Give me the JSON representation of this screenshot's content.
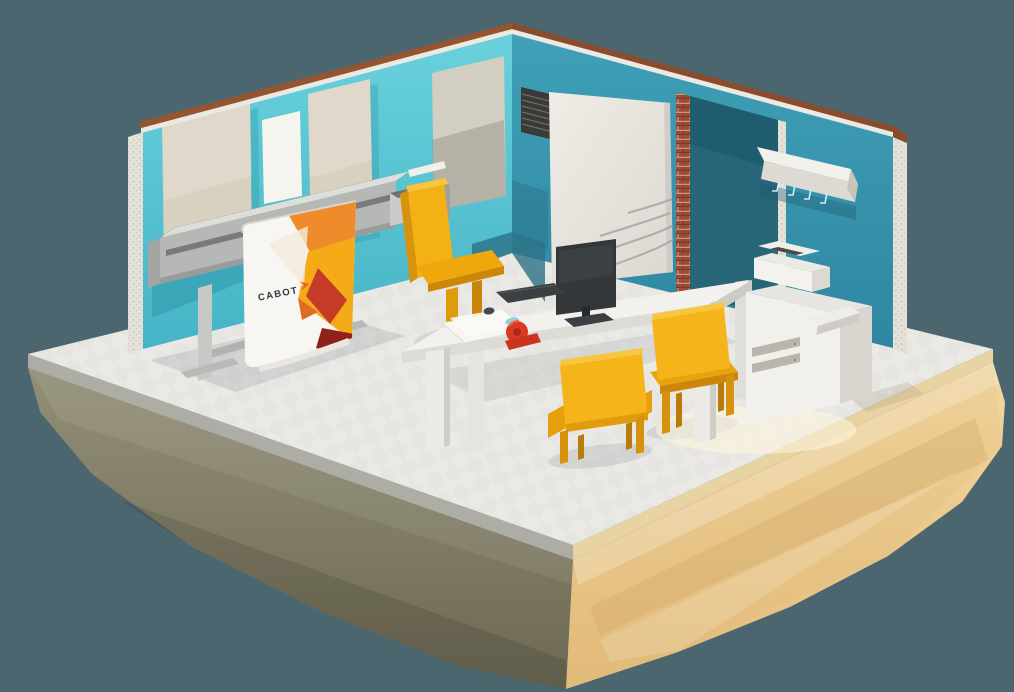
{
  "scene": {
    "title": "Low-poly isometric office room on a floating sand island",
    "background_color": "#4c666f",
    "brand": {
      "banner_text": "CABOT",
      "banner_chevron_color": "#e8641f"
    },
    "palette": {
      "wall_left_teal": "#5cc8d4",
      "wall_right_teal": "#3b9ab1",
      "wall_cap_brown": "#96552f",
      "brick_red": "#9c4a33",
      "floor_gray": "#eae9e6",
      "island_sunlit_tan": "#ecc990",
      "island_shadow_olive": "#7e7a64",
      "furniture_white": "#f2f1ed",
      "chair_yellow": "#f5b51a",
      "banner_orange": "#ef8b2b",
      "banner_yellow": "#f5ab17",
      "banner_red": "#c53b28",
      "banner_dark_red": "#8e211c",
      "monitor_dark": "#33373a",
      "tape_red": "#db3a22",
      "tape_roll_blue": "#8fd2de"
    },
    "objects": [
      {
        "name": "floating-island",
        "description": "faceted sand-colored rock base"
      },
      {
        "name": "floor",
        "description": "light gray floor slab"
      },
      {
        "name": "left-wall",
        "description": "light teal wall with beige panels and poster"
      },
      {
        "name": "right-wall",
        "description": "dark teal wall with doorway"
      },
      {
        "name": "sliding-door",
        "description": "white sliding door panel"
      },
      {
        "name": "doorway",
        "description": "brick-edged door opening"
      },
      {
        "name": "vent",
        "description": "dark wall vent grille"
      },
      {
        "name": "coat-rack",
        "description": "white wall-mounted coat rack with hooks"
      },
      {
        "name": "wide-format-plotter",
        "description": "gray large-format plotter on stand"
      },
      {
        "name": "cabot-banner",
        "description": "printed banner with CABOT logo"
      },
      {
        "name": "desk",
        "description": "white meeting desk"
      },
      {
        "name": "monitor",
        "description": "dark desktop monitor"
      },
      {
        "name": "keyboard",
        "description": "dark keyboard"
      },
      {
        "name": "mouse",
        "description": "small dark mouse"
      },
      {
        "name": "tape-dispenser",
        "description": "red tape dispenser with blue tape"
      },
      {
        "name": "papers",
        "description": "white paper sheets"
      },
      {
        "name": "desk-chair",
        "description": "yellow high-back chair"
      },
      {
        "name": "visitor-chair-left",
        "description": "yellow chair seen from behind"
      },
      {
        "name": "visitor-chair-right",
        "description": "yellow chair seen from behind"
      },
      {
        "name": "copier",
        "description": "white multifunction copier"
      }
    ]
  }
}
